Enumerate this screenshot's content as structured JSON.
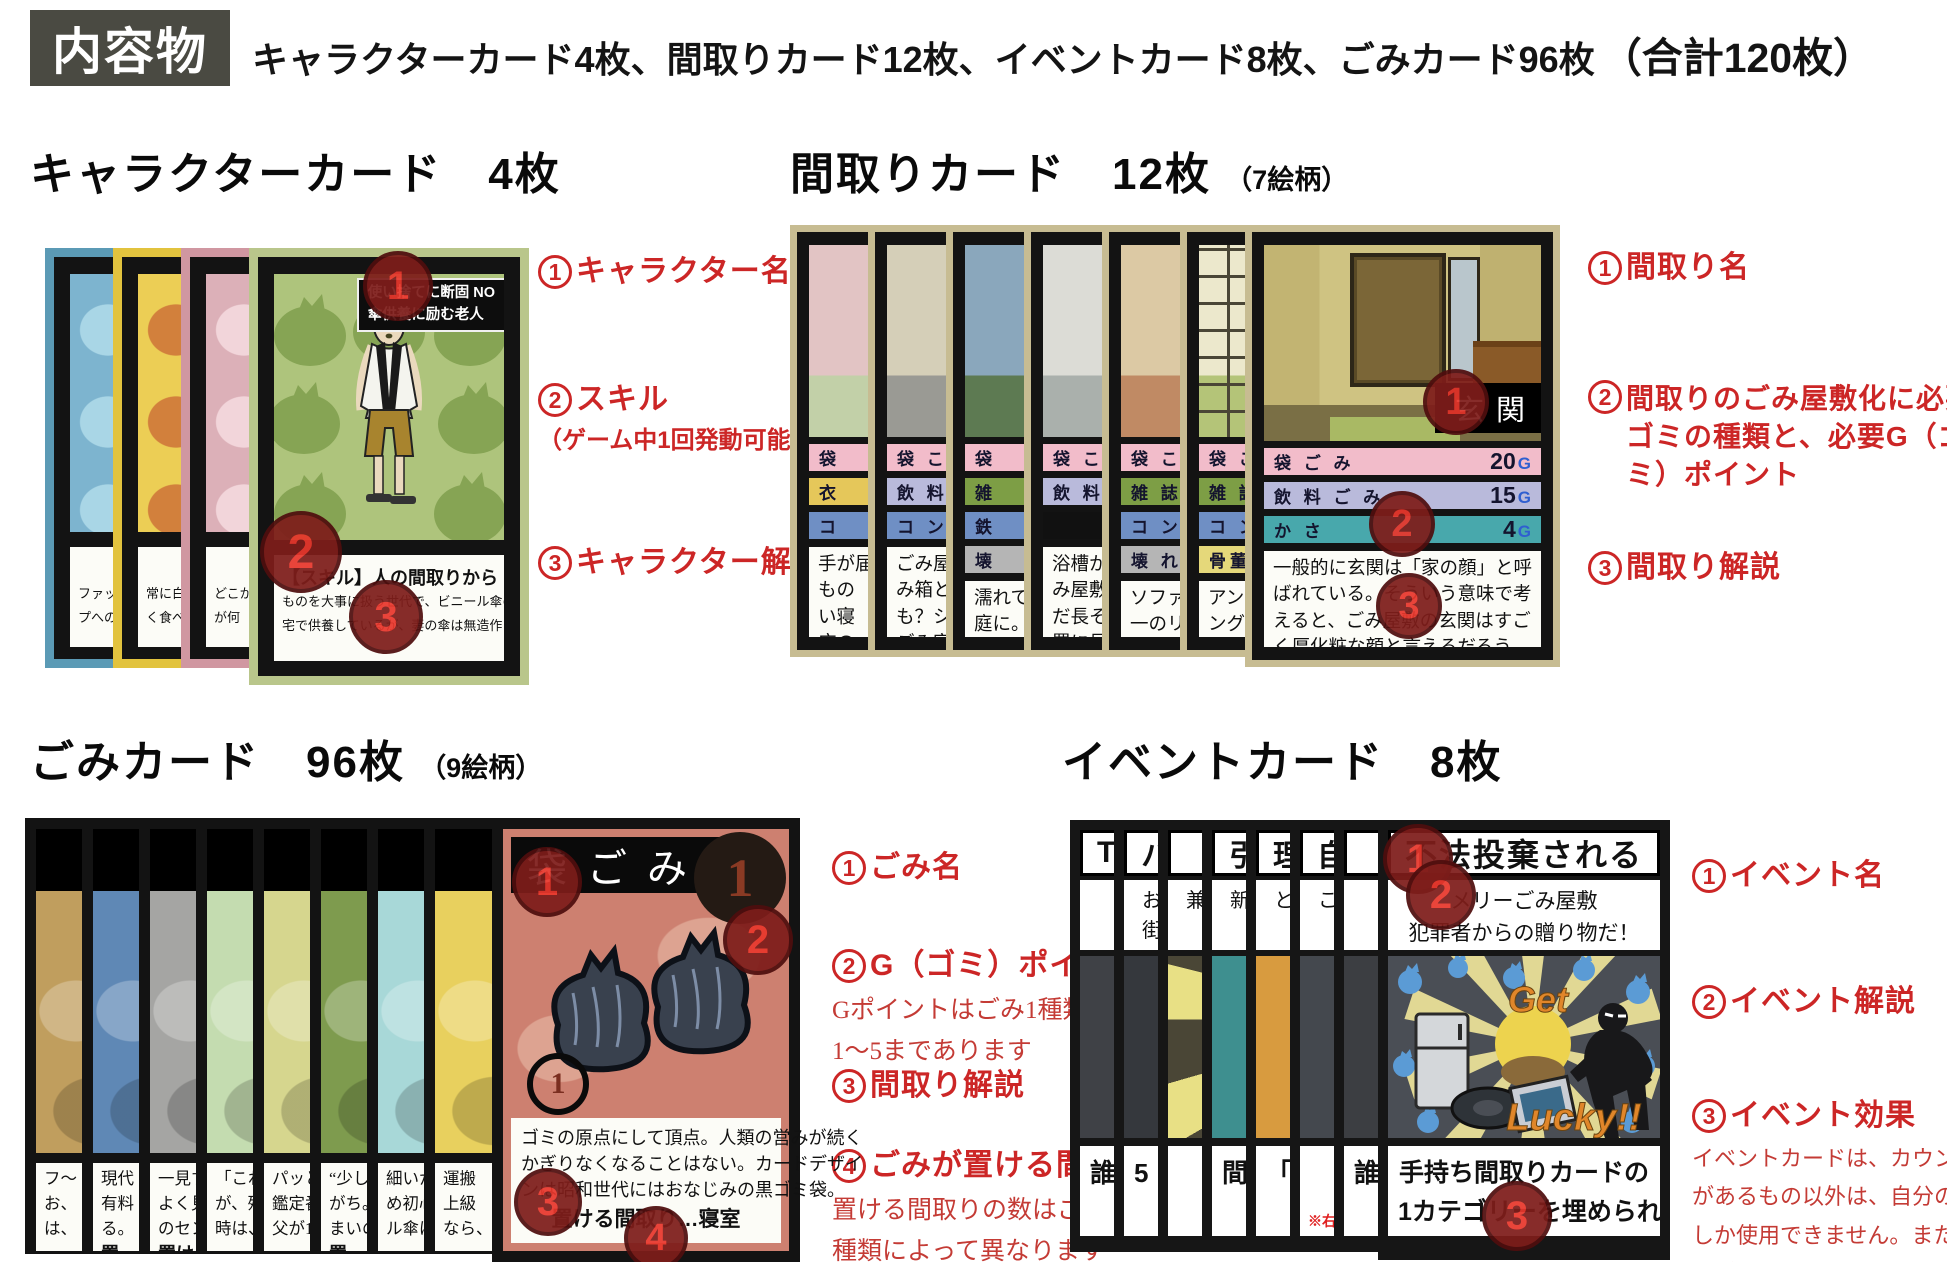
{
  "colors": {
    "annotation_red": "#cc2626",
    "badge_fill": "#7e1d1a",
    "badge_number": "#e8372c",
    "header_box_bg": "#4a4a42",
    "g_letter_blue": "#2f5fd0",
    "event_orange": "#e0862a"
  },
  "header": {
    "box_label": "内容物",
    "line": "キャラクターカード4枚、間取りカード12枚、イベントカード8枚、ごみカード96枚",
    "total": "（合計120枚）"
  },
  "character": {
    "heading": "キャラクターカード　4枚",
    "annotations": [
      {
        "num": "1",
        "label": "キャラクター名"
      },
      {
        "num": "2",
        "label": "スキル",
        "note": "（ゲーム中1回発動可能）"
      },
      {
        "num": "3",
        "label": "キャラクター解説"
      }
    ],
    "front": {
      "title_line1": "使い捨てに断固 NO",
      "title_line2": "傘供養に励む老人",
      "skill_title": "【スキル】人の間取りから「傘」を奪える",
      "desc_lines": [
        "ものを大事に扱う世代で、ビニール傘の使い捨てに心を傷め自",
        "宅で供養しているが、妻の傘は無造作に玄関に置かれている。"
      ]
    },
    "back_cards": [
      {
        "border": "#5b9ab5",
        "art": "#7db4cf",
        "bag": "#a9d6e6",
        "skill": "【ス",
        "lines": [
          "ファッショ",
          "プへの"
        ]
      },
      {
        "border": "#e2c33e",
        "art": "#ecce55",
        "bag": "#d2803c",
        "skill": "【スキル】",
        "lines": [
          "常に白い",
          "く食べる。"
        ]
      },
      {
        "border": "#d097a1",
        "art": "#dcb0b8",
        "bag": "#f2d5da",
        "skill": "【スキ",
        "lines": [
          "どこか",
          "が何"
        ]
      }
    ]
  },
  "madori": {
    "heading": "間取りカード　12枚",
    "heading_note": "（7絵柄）",
    "annotations": [
      {
        "num": "1",
        "label": "間取り名"
      },
      {
        "num": "2",
        "label": "間取りのごみ屋敷化に必要なゴミの種類と、必要G（ゴミ）ポイント"
      },
      {
        "num": "3",
        "label": "間取り解説"
      }
    ],
    "front": {
      "room_name": "玄関",
      "rows": [
        {
          "label": "袋 ご み",
          "value": "20",
          "unit": "G",
          "color": "#f2bcca"
        },
        {
          "label": "飲 料 ご み",
          "value": "15",
          "unit": "G",
          "color": "#b9badb"
        },
        {
          "label": "か さ",
          "value": "4",
          "unit": "G",
          "color": "#48a8ac"
        }
      ],
      "desc_lines": [
        "一般的に玄関は「家の顔」と呼",
        "ばれている。そういう意味で考",
        "えると、ごみ屋敷の玄関はすご",
        "く厚化粧な顔と言えるだろう。"
      ]
    },
    "back_cards": [
      {
        "art": [
          "#e2c4c4",
          "#c2d0a8"
        ],
        "rows": [
          [
            "袋",
            "#f2bcca"
          ],
          [
            "衣",
            "#e5c75a"
          ],
          [
            "コ",
            "#6f8fc4"
          ]
        ],
        "lines": [
          "手が届",
          "もの",
          "い寝",
          "床の"
        ]
      },
      {
        "art": [
          "#d5cfb8",
          "#9a9a94"
        ],
        "rows": [
          [
            "袋 こ",
            "#f2bcca"
          ],
          [
            "飲 料",
            "#b9badb"
          ],
          [
            "コ ン",
            "#6f8fc4"
          ]
        ],
        "lines": [
          "ごみ屋",
          "み箱と",
          "も？シ",
          "ごみ家"
        ]
      },
      {
        "art": [
          "#8aa7bc",
          "#5d7a52"
        ],
        "rows": [
          [
            "袋",
            "#f2bcca"
          ],
          [
            "雑",
            "#7d9e45"
          ],
          [
            "鉄",
            "#6f8fc4"
          ],
          [
            "壊",
            "#b5b5b5"
          ]
        ],
        "lines": [
          "濡れて",
          "庭に。",
          "ごみに"
        ]
      },
      {
        "art": [
          "#dcdcd6",
          "#aab0ac"
        ],
        "rows": [
          [
            "袋 こ",
            "#f2bcca"
          ],
          [
            "飲 料",
            "#b9badb"
          ],
          [
            "",
            "#111111"
          ]
        ],
        "lines": [
          "浴槽か",
          "み屋敷",
          "だ長そ",
          "置に見"
        ]
      },
      {
        "art": [
          "#dcc9a4",
          "#c08a64"
        ],
        "rows": [
          [
            "袋 こ",
            "#f2bcca"
          ],
          [
            "雑 誌",
            "#7d9e45"
          ],
          [
            "コ ン",
            "#6f8fc4"
          ],
          [
            "壊 れ",
            "#b5b5b5"
          ]
        ],
        "lines": [
          "ソファ",
          "一のリ",
          "そのソ"
        ]
      },
      {
        "art": [
          "#ece8cc",
          "#b4c478"
        ],
        "grid": true,
        "rows": [
          [
            "袋 こ",
            "#f2bcca"
          ],
          [
            "雑 誌",
            "#7d9e45"
          ],
          [
            "コ ン",
            "#6f8fc4"
          ],
          [
            "骨董品",
            "#e5d87a"
          ]
        ],
        "lines": [
          "アンビ",
          "ングの",
          "かかれ"
        ]
      }
    ]
  },
  "gomi": {
    "heading": "ごみカード　96枚",
    "heading_note": "（9絵柄）",
    "annotations": [
      {
        "num": "1",
        "label": "ごみ名"
      },
      {
        "num": "2",
        "label": "G（ゴミ）ポイント",
        "note_lines": [
          "Gポイントはごみ1種類につき",
          "1〜5まであります"
        ]
      },
      {
        "num": "3",
        "label": "間取り解説"
      },
      {
        "num": "4",
        "label": "ごみが置ける間取り",
        "note_lines": [
          "置ける間取りの数はごみの",
          "種類によって異なります"
        ]
      }
    ],
    "front": {
      "name": "袋ごみ",
      "big_point": "1",
      "corner_point": "1",
      "desc_lines": [
        "ゴミの原点にして頂点。人類の営みが続く",
        "かぎりなくなることはない。カードデザイ",
        "ンは昭和世代にはおなじみの黒ゴミ袋。"
      ],
      "placement": "置ける間取り…寝室"
    },
    "back_cards": [
      {
        "color": "#c09e5e",
        "title": "",
        "lines": [
          "フ〜",
          "お、",
          "は、"
        ]
      },
      {
        "color": "#5f88b5",
        "title": "ニ",
        "lines": [
          "現代",
          "有料",
          "る。"
        ],
        "bold": "置"
      },
      {
        "color": "#a5a5a3",
        "title": "食",
        "lines": [
          "一見す",
          "よく見",
          "のセン"
        ],
        "bold": "置け"
      },
      {
        "color": "#c4dcb0",
        "title": "家",
        "lines": [
          "「これま",
          "が、残念",
          "時は、"
        ]
      },
      {
        "color": "#d6d68e",
        "title": "骨",
        "lines": [
          "パッと",
          "鑑定番",
          "父が10"
        ]
      },
      {
        "color": "#7e9b4e",
        "title": "",
        "lines": [
          "“少し",
          "がち。",
          "まいの"
        ],
        "bold": "置"
      },
      {
        "color": "#a8d8d8",
        "title": "木",
        "lines": [
          "細いか",
          "め初心",
          "ル傘は"
        ]
      },
      {
        "color": "#e8d05e",
        "title": "",
        "lines": [
          "運搬",
          "上級",
          "なら、"
        ]
      }
    ]
  },
  "event": {
    "heading": "イベントカード　8枚",
    "annotations": [
      {
        "num": "1",
        "label": "イベント名"
      },
      {
        "num": "2",
        "label": "イベント解説"
      },
      {
        "num": "3",
        "label": "イベント効果",
        "note_lines": [
          "イベントカードは、カウンター効果",
          "があるもの以外は、自分のターンに",
          "しか使用できません。また、使用後",
          "はゴミ山に捨ててください。"
        ]
      }
    ],
    "front": {
      "name": "不法投棄される",
      "desc_lines": [
        "メリーごみ屋敷",
        "犯罪者からの贈り物だ！"
      ],
      "art_text1": "Get",
      "art_text2": "Lucky!!",
      "effect_lines": [
        "手持ち間取りカードの",
        "1カテゴリーを埋められるぞ！"
      ]
    },
    "back_cards": [
      {
        "title": "T",
        "sub": [
          "",
          ""
        ],
        "color": "#3f4146",
        "bottom": [
          "誰",
          ""
        ]
      },
      {
        "title": "ハ",
        "sub": [
          "お",
          "街"
        ],
        "color": "#35383d",
        "bottom": [
          "5",
          "3"
        ]
      },
      {
        "title": "",
        "sub": [
          "兼",
          ""
        ],
        "color": "#5a5530",
        "burst": true,
        "bottom": [
          "",
          "3"
        ]
      },
      {
        "title": "引",
        "sub": [
          "新",
          ""
        ],
        "color": "#3e8f8f",
        "bottom": [
          "間",
          "全"
        ]
      },
      {
        "title": "理",
        "sub": [
          "と",
          ""
        ],
        "color": "#d89b3f",
        "bottom": [
          "「",
          "カ"
        ]
      },
      {
        "title": "自",
        "sub": [
          "こ",
          ""
        ],
        "color": "#44484e",
        "bottom": [
          "",
          ""
        ],
        "note": "※右"
      },
      {
        "title": "",
        "sub": [
          "",
          ""
        ],
        "color": "#3c3e42",
        "bottom": [
          "誰",
          ""
        ]
      }
    ]
  }
}
